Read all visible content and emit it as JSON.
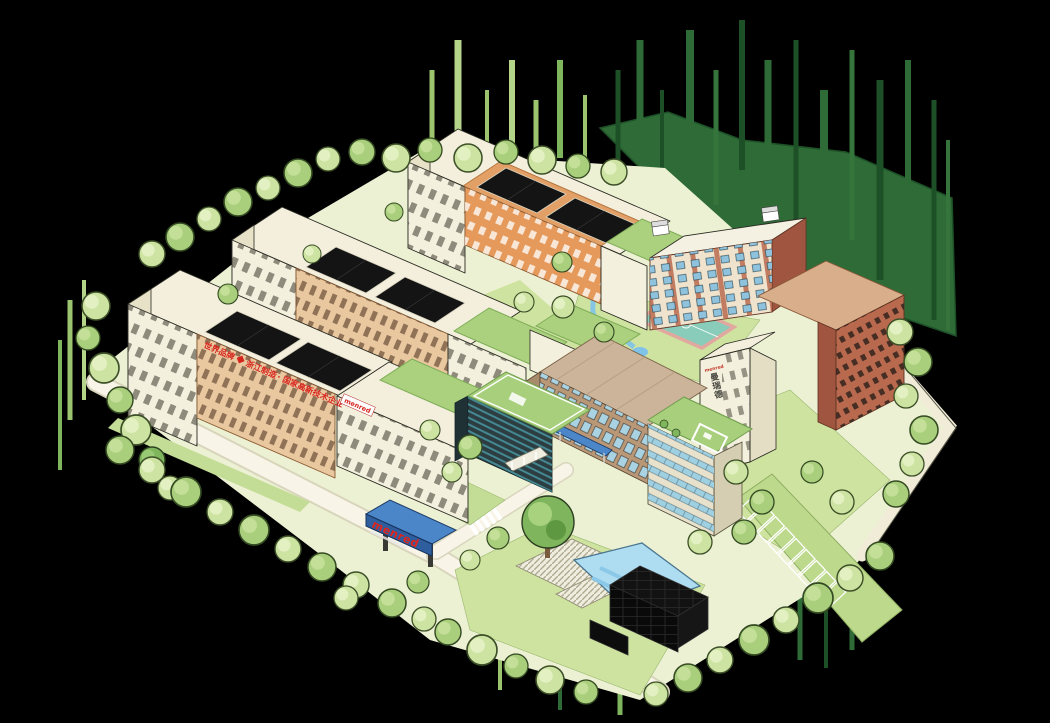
{
  "scene": {
    "description": "Bird's-eye illustrated map of the menred industrial campus",
    "background": "#000000"
  },
  "signage": {
    "factory_slogan_part1": "世界品牌",
    "factory_slogan_part2": "浙江制造",
    "factory_slogan_separator": "·",
    "factory_slogan_part3": "国家高新技术企业",
    "factory_corner_sign": "menred",
    "office_tower_sign": "menred",
    "office_tower_vertical_sign": "曼瑞德",
    "entrance_gate_sign": "menred"
  },
  "colors": {
    "brand_red": "#d6251d",
    "canopy_blue": "#4a86c8",
    "roof_green": "#a8cf7c",
    "pool_blue": "#aedcf0",
    "brick": "#b96a4e",
    "factory_tan": "#e9c8a0",
    "building_cream": "#f3efdc",
    "forest_green": "#2e6b36",
    "solar_black": "#141414"
  }
}
